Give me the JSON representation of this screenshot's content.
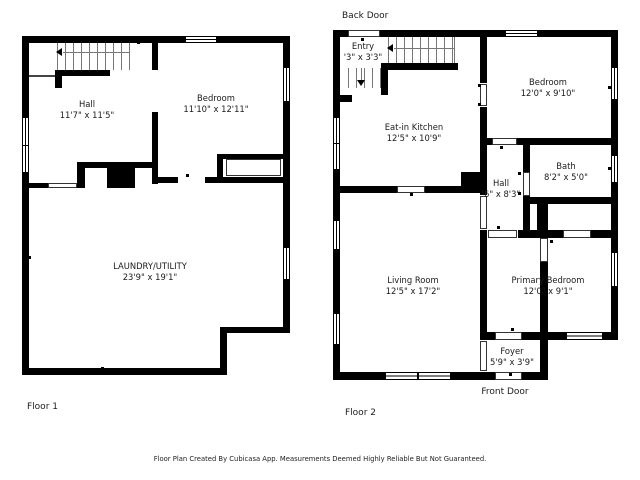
{
  "title": "Floor Plan",
  "colors": {
    "wall": "#000000",
    "background": "#ffffff",
    "tread_line": "#777777",
    "text": "#1b1b1b"
  },
  "footer": {
    "text": "Floor Plan Created By Cubicasa App. Measurements Deemed Highly Reliable But Not Guaranteed."
  },
  "floor1": {
    "label": "Floor 1",
    "rooms": [
      {
        "name": "Hall",
        "dims": "11'7\" x 11'5\""
      },
      {
        "name": "Bedroom",
        "dims": "11'10\" x 12'11\""
      },
      {
        "name": "LAUNDRY/UTILITY",
        "dims": "23'9\" x 19'1\""
      }
    ]
  },
  "floor2": {
    "label": "Floor 2",
    "back_door_label": "Back Door",
    "front_door_label": "Front Door",
    "rooms": [
      {
        "name": "Entry",
        "dims": "'3\" x 3'3\""
      },
      {
        "name": "Eat-in Kitchen",
        "dims": "12'5\" x 10'9\""
      },
      {
        "name": "Bedroom",
        "dims": "12'0\" x 9'10\""
      },
      {
        "name": "Bath",
        "dims": "8'2\" x 5'0\""
      },
      {
        "name": "Hall",
        "dims": "'6\" x 8'3\""
      },
      {
        "name": "Living Room",
        "dims": "12'5\" x 17'2\""
      },
      {
        "name": "Primary Bedroom",
        "dims": "12'0\" x 9'1\""
      },
      {
        "name": "Foyer",
        "dims": "5'9\" x 3'9\""
      }
    ]
  }
}
